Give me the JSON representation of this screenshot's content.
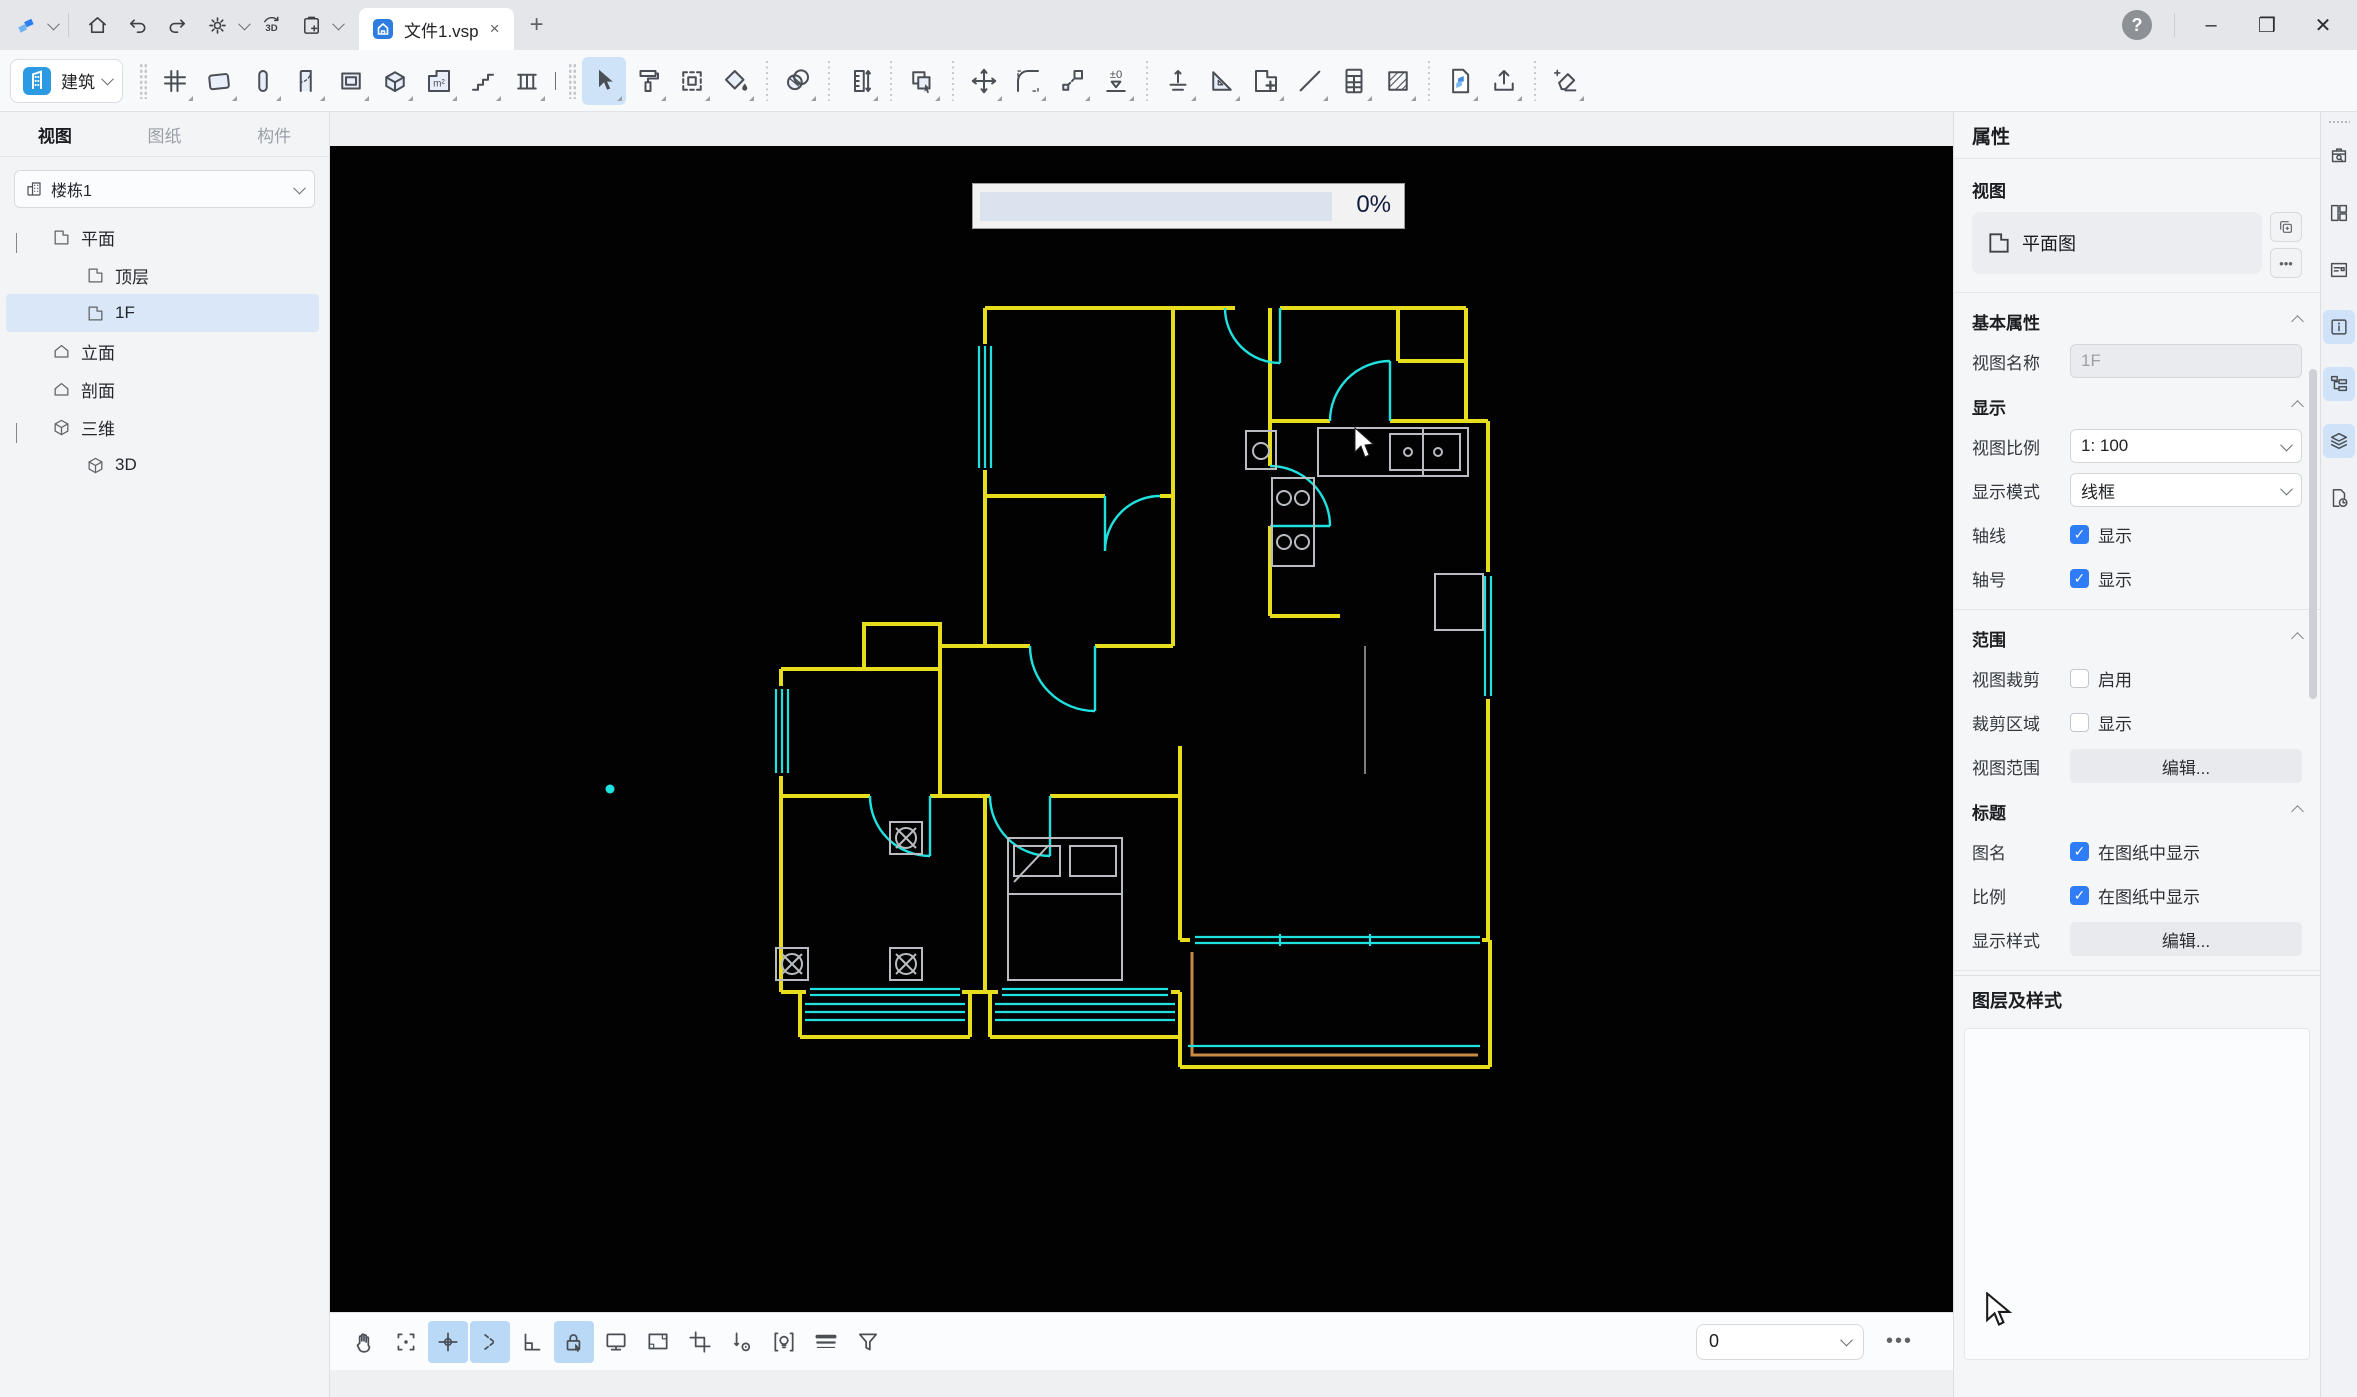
{
  "watermark": {
    "primary": "SUH26-WYKJN",
    "secondary": "SUH26",
    "tertiary": "WYKJN"
  },
  "titlebar": {
    "document_tab": "文件1.vsp"
  },
  "ribbon": {
    "mode": "建筑",
    "build_icons": [
      "grid",
      "wall",
      "column",
      "door",
      "window",
      "opening",
      "room-area",
      "stairs",
      "railing"
    ],
    "edit_icons": [
      "select*",
      "format-painter",
      "box-select",
      "fill",
      "|",
      "material",
      "|",
      "measure",
      "|",
      "copy",
      "|",
      "move",
      "fillet",
      "scale",
      "level",
      "|",
      "align",
      "triangle-ruler",
      "plan-add",
      "line",
      "schedule",
      "hatch",
      "|",
      "import",
      "export",
      "|",
      "cleanup"
    ]
  },
  "sidebar": {
    "tabs": [
      {
        "label": "视图",
        "active": true
      },
      {
        "label": "图纸",
        "active": false
      },
      {
        "label": "构件",
        "active": false
      }
    ],
    "building": "楼栋1",
    "tree": [
      {
        "label": "平面",
        "level": 0,
        "icon": "plan",
        "expanded": true
      },
      {
        "label": "顶层",
        "level": 1,
        "icon": "plan"
      },
      {
        "label": "1F",
        "level": 1,
        "icon": "plan",
        "selected": true
      },
      {
        "label": "立面",
        "level": 0,
        "icon": "house"
      },
      {
        "label": "剖面",
        "level": 0,
        "icon": "house"
      },
      {
        "label": "三维",
        "level": 0,
        "icon": "cube",
        "expanded": true
      },
      {
        "label": "3D",
        "level": 1,
        "icon": "cube"
      },
      {
        "label": "参照底图",
        "level": 0,
        "icon": "underlay"
      }
    ]
  },
  "canvas": {
    "tabs": [
      {
        "label": "3D",
        "icon": "cube",
        "active": false
      },
      {
        "label": "1F",
        "icon": "plan",
        "active": true,
        "closable": true
      }
    ],
    "progress_label": "0%",
    "rooms": [
      {
        "name": "次卧",
        "area": "6.60m²",
        "x": 755,
        "y": 245
      },
      {
        "name": "玄关",
        "area": "2.06m²",
        "x": 893,
        "y": 218
      },
      {
        "name": "卫生间",
        "area": "4.08m²",
        "x": 1022,
        "y": 218
      },
      {
        "name": "管井",
        "area": "0.20m²",
        "x": 1097,
        "y": 182
      },
      {
        "name": "过道",
        "area": "2.58m²",
        "x": 893,
        "y": 327
      },
      {
        "name": "厨房",
        "area": "5.22m²",
        "x": 1032,
        "y": 342
      },
      {
        "name": "次卧",
        "area": "8.41m²",
        "x": 746,
        "y": 422
      },
      {
        "name": "餐厅",
        "area": "6.05m²",
        "x": 1032,
        "y": 457
      },
      {
        "name": "管井",
        "area": "0.19m²",
        "x": 566,
        "y": 494
      },
      {
        "name": "卫生间",
        "area": "4.16m²",
        "x": 507,
        "y": 554
      },
      {
        "name": "过道",
        "area": "4.38m²",
        "x": 764,
        "y": 565
      },
      {
        "name": "客厅",
        "area": "21.00m²",
        "x": 988,
        "y": 657
      },
      {
        "name": "主卧",
        "area": "14.31m²",
        "x": 560,
        "y": 732
      },
      {
        "name": "次卧",
        "area": "10.29m²",
        "x": 758,
        "y": 732
      }
    ]
  },
  "bottombar": {
    "icons": [
      "pan",
      "zoom-fit",
      "snap*",
      "track*",
      "ortho",
      "lock-select*",
      "display",
      "viewport",
      "crop-view",
      "measure-point",
      "light",
      "line-weight",
      "filter"
    ],
    "level_value": "0"
  },
  "rail_icons": [
    "component-search",
    "layout",
    "sheet-note",
    "info*",
    "structure-tree*",
    "layers*",
    "history"
  ],
  "properties": {
    "panel_title": "属性",
    "view_group_label": "视图",
    "view_type": "平面图",
    "basic": {
      "title": "基本属性",
      "name_label": "视图名称",
      "name_value": "1F"
    },
    "display": {
      "title": "显示",
      "scale_label": "视图比例",
      "scale_value": "1: 100",
      "mode_label": "显示模式",
      "mode_value": "线框",
      "axis_label": "轴线",
      "axis_text": "显示",
      "axisnum_label": "轴号",
      "axisnum_text": "显示"
    },
    "range": {
      "title": "范围",
      "crop_label": "视图裁剪",
      "crop_text": "启用",
      "area_label": "裁剪区域",
      "area_text": "显示",
      "vr_label": "视图范围",
      "vr_button": "编辑..."
    },
    "titleblock": {
      "title": "标题",
      "name_label": "图名",
      "name_text": "在图纸中显示",
      "scale_label": "比例",
      "scale_text": "在图纸中显示",
      "style_label": "显示样式",
      "style_button": "编辑..."
    },
    "underlay_title": "参照底图",
    "layers_title": "图层及样式"
  }
}
